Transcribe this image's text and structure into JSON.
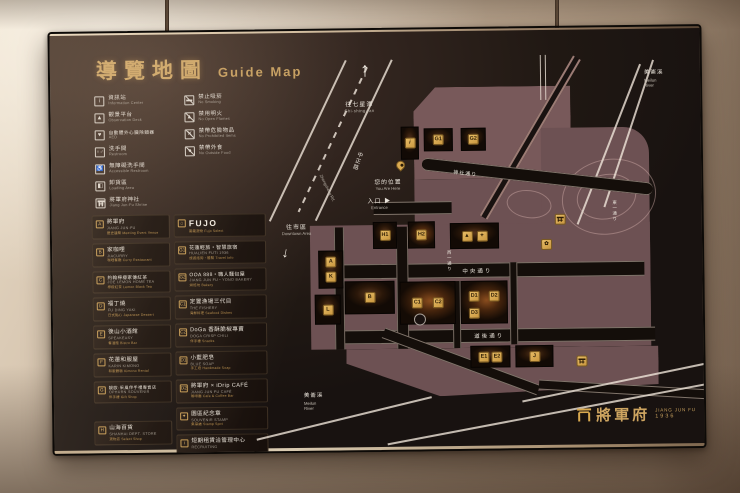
{
  "title": {
    "zh": "導覽地圖",
    "en": "Guide Map"
  },
  "legend": {
    "facilities": [
      {
        "zh": "資訊站",
        "en": "Information Center",
        "glyph": "i"
      },
      {
        "zh": "觀景平台",
        "en": "Observation Deck",
        "glyph": "▲"
      },
      {
        "zh": "自動體外心臟除顫器",
        "en": "AED",
        "glyph": "♥"
      },
      {
        "zh": "洗手間",
        "en": "Restroom",
        "glyph": "♀♂"
      },
      {
        "zh": "無障礙洗手間",
        "en": "Accessible Restroom",
        "glyph": "♿"
      },
      {
        "zh": "卸貨區",
        "en": "Loading Area",
        "glyph": "◧"
      },
      {
        "zh": "將軍府神社",
        "en": "Jiang Jun-Fu Shrine",
        "glyph": ""
      }
    ],
    "rules": [
      {
        "zh": "禁止吸菸",
        "en": "No Smoking",
        "glyph": "▬"
      },
      {
        "zh": "禁用明火",
        "en": "No Open Flames",
        "glyph": "▲"
      },
      {
        "zh": "禁帶危險物品",
        "en": "No Prohibited Items",
        "glyph": "✕"
      },
      {
        "zh": "禁帶外食",
        "en": "No Outside Food",
        "glyph": "●"
      }
    ]
  },
  "directory": {
    "left": [
      {
        "id": "A",
        "zh": "將軍府",
        "en": "JIANG JUN-FU",
        "sub": "歷史建築 Meeting Event Venue"
      },
      {
        "id": "B",
        "zh": "家咖哩",
        "en": "JIACURRY",
        "sub": "咖哩餐廳 Curry Restaurant"
      },
      {
        "id": "C",
        "zh": "約翰檸檬家傳紅茶",
        "en": "JOE LEMON HOME TEA",
        "sub": "檸檬紅茶 Lemon Black Tea"
      },
      {
        "id": "D",
        "zh": "福丁燒",
        "en": "FU DING YAKI",
        "sub": "日式點心 Japanese Dessert"
      },
      {
        "id": "E",
        "zh": "後山小酒館",
        "en": "SPEAKEASY",
        "sub": "餐酒館 Bistro Bar"
      },
      {
        "id": "F",
        "zh": "花蓮和服屋",
        "en": "KARIN KIMONO",
        "sub": "和服體驗 Kimono Rental"
      },
      {
        "id": "G",
        "zh": "靚歐·采風伴手禮專賣店",
        "en": "OPHURN SOUVENIR",
        "sub": "伴手禮 Gift Shop"
      },
      {
        "id": "H",
        "zh": "山海百貨",
        "en": "SHANHAI DEPT. STORE",
        "sub": "選物店 Select Shop"
      }
    ],
    "fujo": {
      "label": "FUJO",
      "sub": "富藏選物 Fujo Select"
    },
    "middle": [
      {
        "id": "G1",
        "zh": "花蓮輕旅・智慧旅宿",
        "en": "HUALIEN FUTI 1936",
        "sub": "旅遊諮詢・體驗 Travel Info"
      },
      {
        "id": "G2",
        "zh": "OOA 888・職人麵包屋",
        "en": "JIANG JUN FU・YONO BAKERY",
        "sub": "烘焙坊 Bakery"
      },
      {
        "id": "C1",
        "zh": "定置漁場三代目",
        "en": "THE FISHERY",
        "sub": "海鮮料理 Seafood Dishes"
      },
      {
        "id": "C2",
        "zh": "DoGa 香酥脆椒專賣",
        "en": "DOGA CRISP CHILI",
        "sub": "伴手禮 Snacks"
      },
      {
        "id": "D1",
        "zh": "小藍肥皂",
        "en": "BLUE SOAP",
        "sub": "手工皂 Handmade Soap"
      },
      {
        "id": "D2",
        "zh": "將軍府 × iDrip CAFÉ",
        "en": "JIANG JUN FU CAFÉ",
        "sub": "咖啡廳 Cafe & Coffee Bar"
      },
      {
        "id": "ST",
        "zh": "園區紀念章",
        "en": "SOUVENIR STAMP",
        "sub": "集章處 Stamp Spot"
      },
      {
        "id": "i",
        "zh": "短期租賃洽管理中心",
        "en": "RECRUITING",
        "sub": ""
      }
    ]
  },
  "map": {
    "directions": {
      "north_zh": "往七星潭",
      "north_en": "Chi-shing-tan",
      "downtown_zh": "往市區",
      "downtown_en": "Downtown Area",
      "entrance_zh": "入口 ▶",
      "entrance_en": "Entrance",
      "here_zh": "您的位置",
      "here_en": "You Are Here",
      "arrow_up": "↑",
      "arrow_down": "↓"
    },
    "streets": {
      "zhongzheng_zh": "中正路",
      "zhongzheng_en": "Zhongzheng Rd.",
      "shrine": "神社通り",
      "central": "中央通り",
      "doko": "道後通り",
      "west1": "西一通り",
      "east1": "東一通り"
    },
    "rivers": {
      "zh": "美崙溪",
      "en1": "Meilun",
      "en2": "River"
    },
    "chips": {
      "g1": "G1",
      "g2": "G2",
      "h1": "H1",
      "h2": "H2",
      "a": "A",
      "k": "K",
      "l": "L",
      "b": "B",
      "c1": "C1",
      "c2": "C2",
      "d1": "D1",
      "d2": "D2",
      "d3": "D3",
      "e1": "E1",
      "e2": "E2",
      "j": "J",
      "i": "i",
      "scenic1": "▲",
      "scenic2": "✦",
      "garden": "✿"
    }
  },
  "logo": {
    "zh": "將軍府",
    "en": "JIANG JUN FU",
    "year": "1936"
  }
}
